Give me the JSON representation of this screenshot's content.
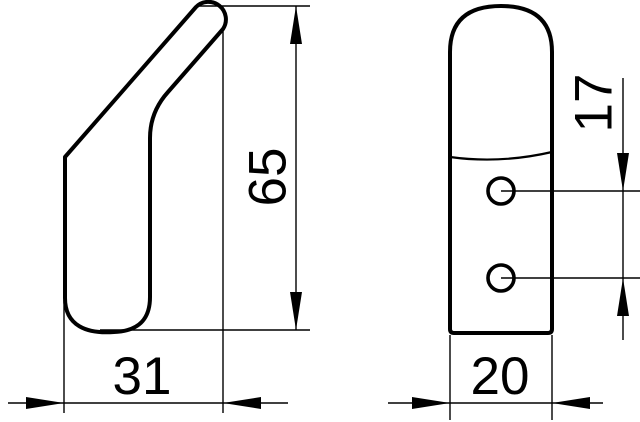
{
  "drawing": {
    "title": "hook-two-view-dimension-drawing",
    "colors": {
      "line": "#000000",
      "background": "#ffffff"
    },
    "side_view": {
      "name": "side-profile-view",
      "width_dim": "31",
      "height_dim": "65"
    },
    "front_view": {
      "name": "front-view",
      "width_dim": "20",
      "hole_spacing_dim": "17",
      "hole_count": 2
    }
  }
}
